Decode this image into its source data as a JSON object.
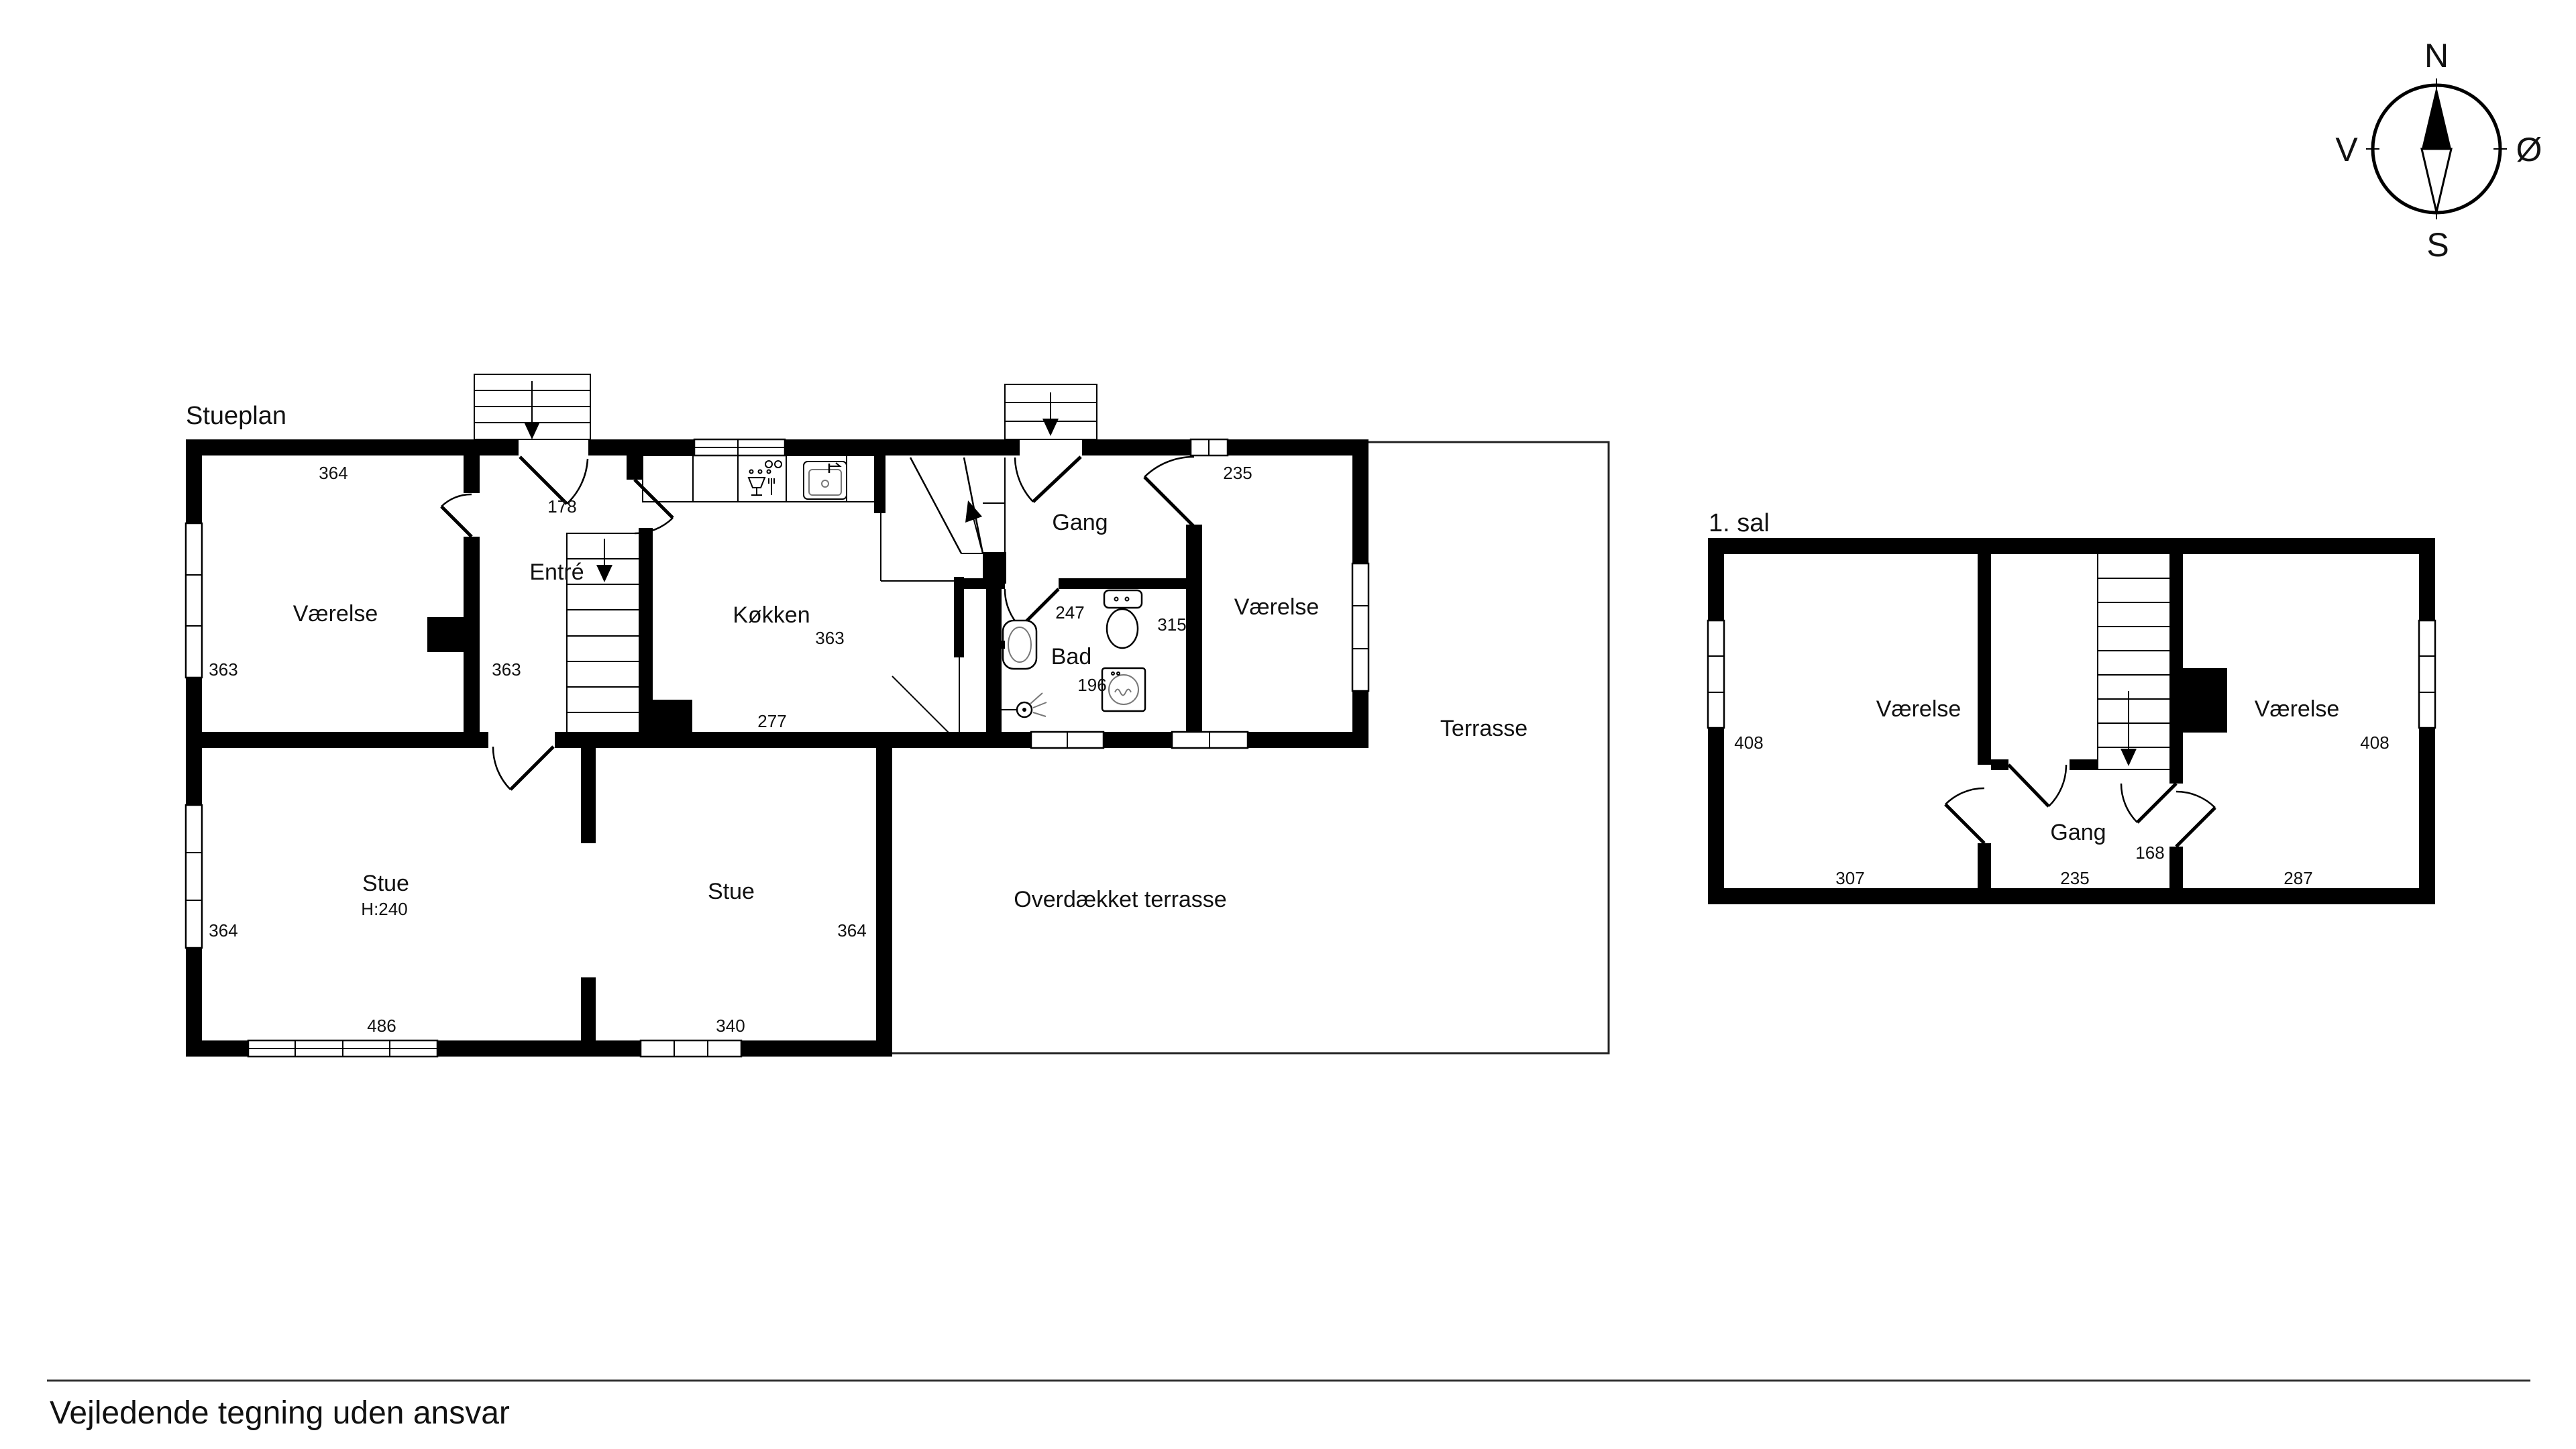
{
  "ground_floor": {
    "title": "Stueplan",
    "rooms": {
      "vaerelse_nw": "Værelse",
      "entre": "Entré",
      "kokken": "Køkken",
      "gang": "Gang",
      "bad": "Bad",
      "vaerelse_ne": "Værelse",
      "terrasse": "Terrasse",
      "stue_w": "Stue",
      "stue_w_height": "H:240",
      "stue_e": "Stue",
      "overdaekket": "Overdækket terrasse"
    },
    "dims": {
      "vaerelse_nw_top": "364",
      "front_door": "178",
      "vaerelse_nw_left": "363",
      "entre_wall": "363",
      "kokken_right": "363",
      "kokken_bottom": "277",
      "gang": "247",
      "bad": "196",
      "vaerelse_ne_top": "235",
      "vaerelse_ne_left": "315",
      "stue_w_left": "364",
      "stue_w_bottom": "486",
      "stue_e_right": "364",
      "stue_e_bottom": "340"
    }
  },
  "first_floor": {
    "title": "1. sal",
    "rooms": {
      "vaerelse_w": "Værelse",
      "vaerelse_e": "Værelse",
      "gang": "Gang"
    },
    "dims": {
      "vaerelse_w_side": "408",
      "vaerelse_e_side": "408",
      "gang_width": "168",
      "bottom_left": "307",
      "bottom_center": "235",
      "bottom_right": "287"
    }
  },
  "compass": {
    "north": "N",
    "south": "S",
    "west": "V",
    "east": "Ø"
  },
  "footer": {
    "disclaimer": "Vejledende tegning uden ansvar"
  }
}
